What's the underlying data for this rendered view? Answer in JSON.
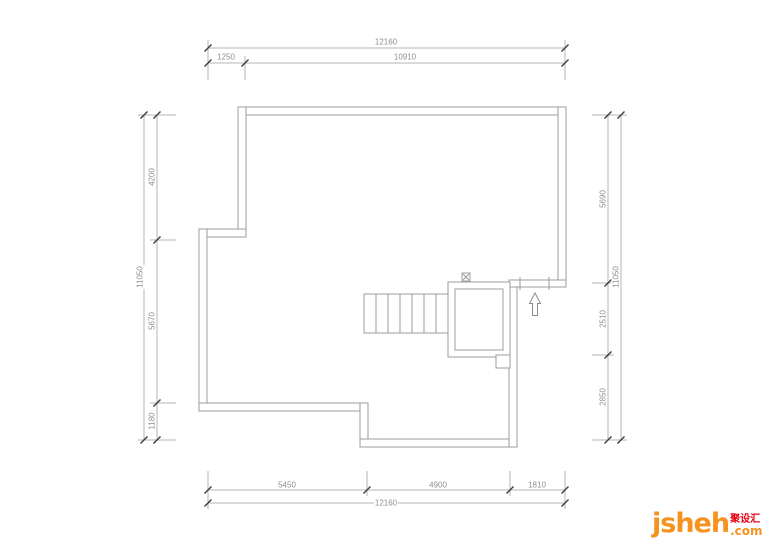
{
  "drawing_type": "roof floor plan (CAD dimension drawing)",
  "dims": {
    "top": {
      "total": "12160",
      "segments": [
        "1250",
        "10910"
      ]
    },
    "bottom": {
      "total": "12160",
      "segments": [
        "5450",
        "4900",
        "1810"
      ]
    },
    "left": {
      "total": "11050",
      "segments": [
        "4200",
        "5670",
        "1180"
      ]
    },
    "right": {
      "total": "11050",
      "segments": [
        "5690",
        "2510",
        "2850"
      ]
    }
  },
  "logo": {
    "brand": "jsheh",
    "cn": "聚设汇",
    "tld": ".com"
  },
  "colors": {
    "wall_line": "#9c9c9c",
    "dimension_line": "#b5b5b5",
    "tick_mark": "#3f3f3f",
    "dimension_text": "#8f8f8f",
    "logo_orange": "#f6921e",
    "logo_red": "#e60013",
    "background": "#ffffff"
  }
}
